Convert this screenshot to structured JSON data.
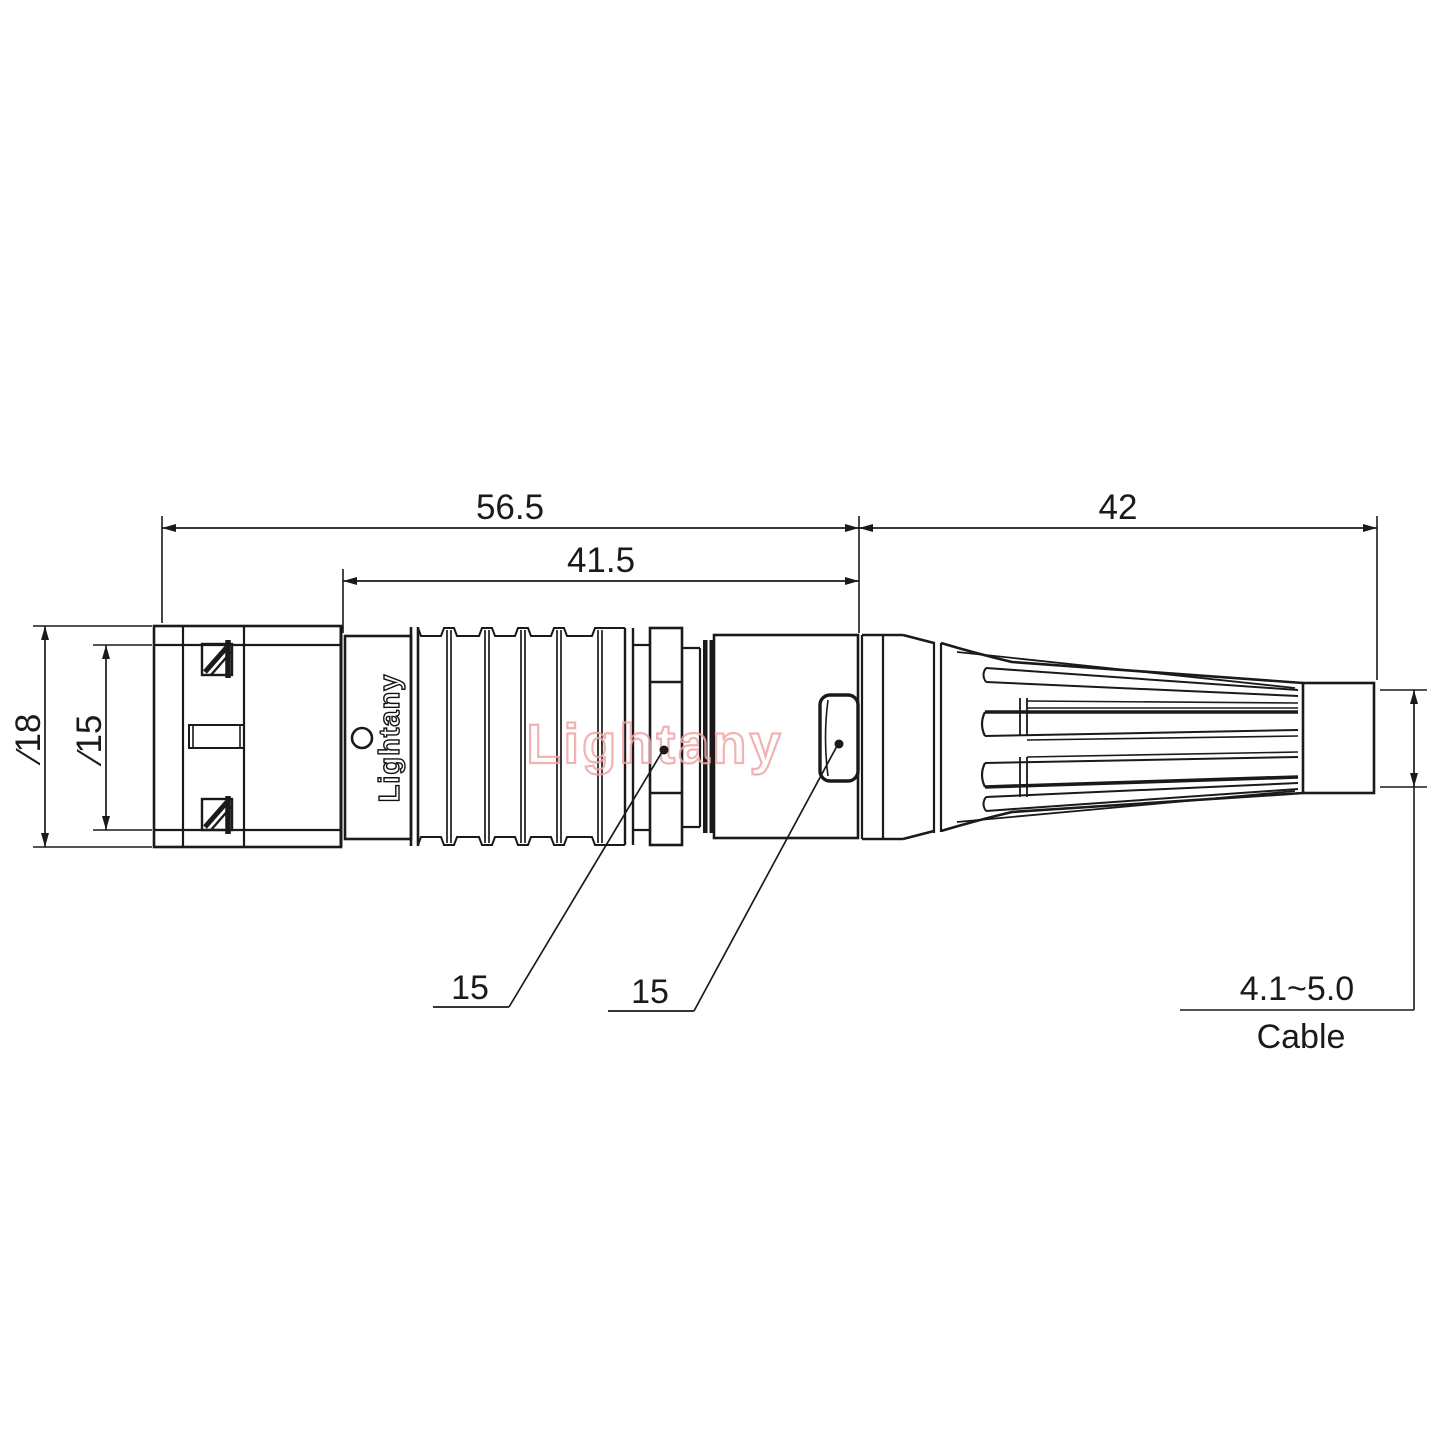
{
  "drawing": {
    "title": "connector-technical-drawing",
    "dims": {
      "overall_length": "56.5",
      "body_length": "41.5",
      "relief_length": "42",
      "outer_diameter": "∕18",
      "inner_diameter": "∕15",
      "wrench_front": "15",
      "wrench_rear": "15",
      "cable_range": "4.1~5.0",
      "cable_caption": "Cable"
    },
    "branding": {
      "engraving": "Lightany",
      "watermark": "Lightany"
    },
    "colors": {
      "line": "#1a1a1a",
      "watermark": "#efa5a5",
      "background": "#ffffff"
    }
  }
}
